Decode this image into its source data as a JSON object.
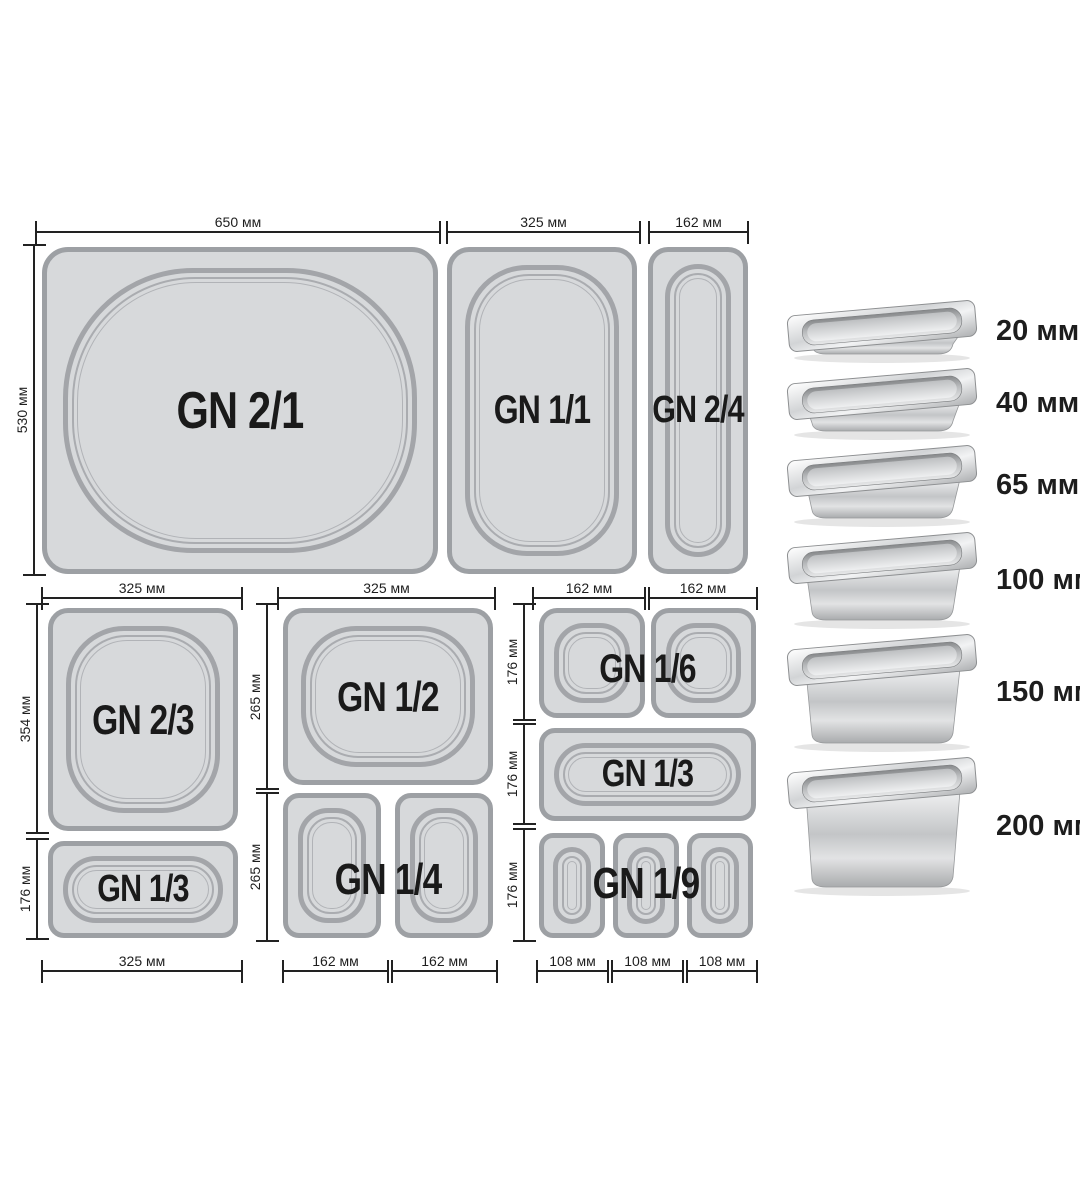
{
  "title": "Gastronorm GN container sizes diagram",
  "units": "мм",
  "colors": {
    "pan_fill": "#d7d9db",
    "pan_border": "#9da0a4",
    "bowl_line": "#a3a5a9",
    "dim_line": "#222222",
    "label_text": "#1a1a1a",
    "background": "#ffffff"
  },
  "pans": {
    "gn21": "GN 2/1",
    "gn11": "GN 1/1",
    "gn24": "GN 2/4",
    "gn23": "GN 2/3",
    "gn13": "GN 1/3",
    "gn12": "GN 1/2",
    "gn14": "GN 1/4",
    "gn16": "GN 1/6",
    "gn19": "GN 1/9"
  },
  "dims": {
    "d650": "650 мм",
    "d530": "530 мм",
    "d354": "354 мм",
    "d325": "325 мм",
    "d265": "265 мм",
    "d176": "176 мм",
    "d162": "162 мм",
    "d108": "108 мм"
  },
  "depths": {
    "items": [
      {
        "mm": 20,
        "label": "20 мм"
      },
      {
        "mm": 40,
        "label": "40 мм"
      },
      {
        "mm": 65,
        "label": "65 мм"
      },
      {
        "mm": 100,
        "label": "100 мм"
      },
      {
        "mm": 150,
        "label": "150 мм"
      },
      {
        "mm": 200,
        "label": "200 мм"
      }
    ]
  }
}
